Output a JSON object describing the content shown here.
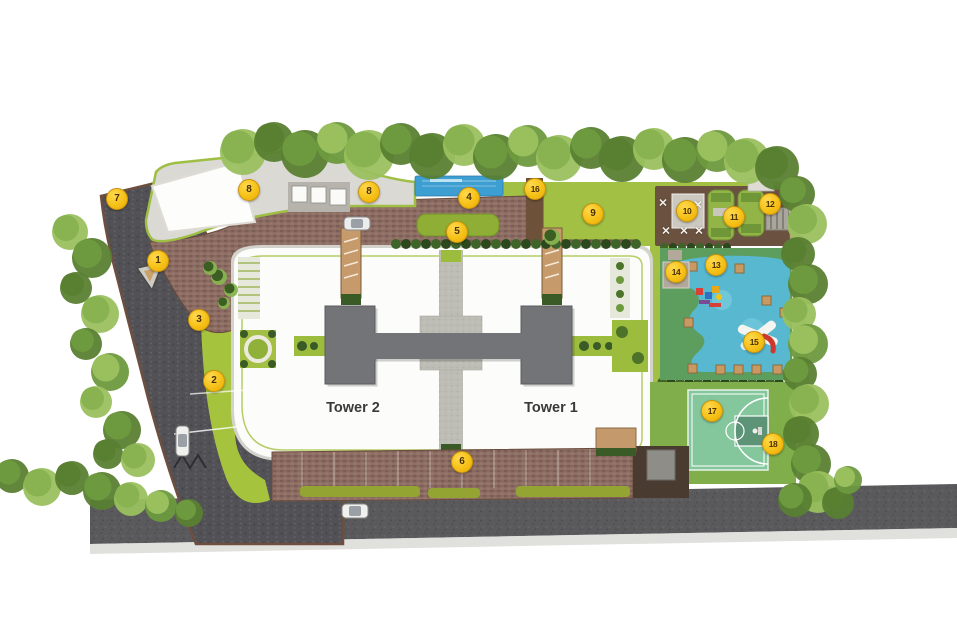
{
  "site_plan": {
    "tower_labels": {
      "tower1": "Tower 1",
      "tower2": "Tower 2"
    },
    "markers": [
      {
        "label": "1",
        "x": 157,
        "y": 260
      },
      {
        "label": "2",
        "x": 213,
        "y": 380
      },
      {
        "label": "3",
        "x": 198,
        "y": 319
      },
      {
        "label": "4",
        "x": 468,
        "y": 197
      },
      {
        "label": "5",
        "x": 456,
        "y": 231
      },
      {
        "label": "6",
        "x": 461,
        "y": 461
      },
      {
        "label": "7",
        "x": 116,
        "y": 198
      },
      {
        "label": "8",
        "x": 248,
        "y": 189
      },
      {
        "label": "8",
        "x": 368,
        "y": 191
      },
      {
        "label": "9",
        "x": 592,
        "y": 213
      },
      {
        "label": "10",
        "x": 686,
        "y": 210
      },
      {
        "label": "11",
        "x": 733,
        "y": 216
      },
      {
        "label": "12",
        "x": 769,
        "y": 203
      },
      {
        "label": "13",
        "x": 715,
        "y": 264
      },
      {
        "label": "14",
        "x": 675,
        "y": 271
      },
      {
        "label": "15",
        "x": 753,
        "y": 341
      },
      {
        "label": "16",
        "x": 534,
        "y": 188
      },
      {
        "label": "17",
        "x": 711,
        "y": 410
      },
      {
        "label": "18",
        "x": 772,
        "y": 443
      }
    ],
    "ground_marks": {
      "x_mark": "✕",
      "positions": [
        {
          "x": 663,
          "y": 203
        },
        {
          "x": 698,
          "y": 205
        },
        {
          "x": 666,
          "y": 231
        },
        {
          "x": 684,
          "y": 231
        },
        {
          "x": 699,
          "y": 231
        }
      ]
    },
    "colors": {
      "marker_fill": "#f6c117",
      "marker_text": "#4a3000",
      "road": "#57565a",
      "brick_paving": "#8d6d63",
      "lawn": "#a2c043",
      "pool_water": "#3d9ed2",
      "kids_soft_surface": "#57b8cf",
      "basketball_court": "#85c79d",
      "tower_footprint": "#737478"
    }
  }
}
